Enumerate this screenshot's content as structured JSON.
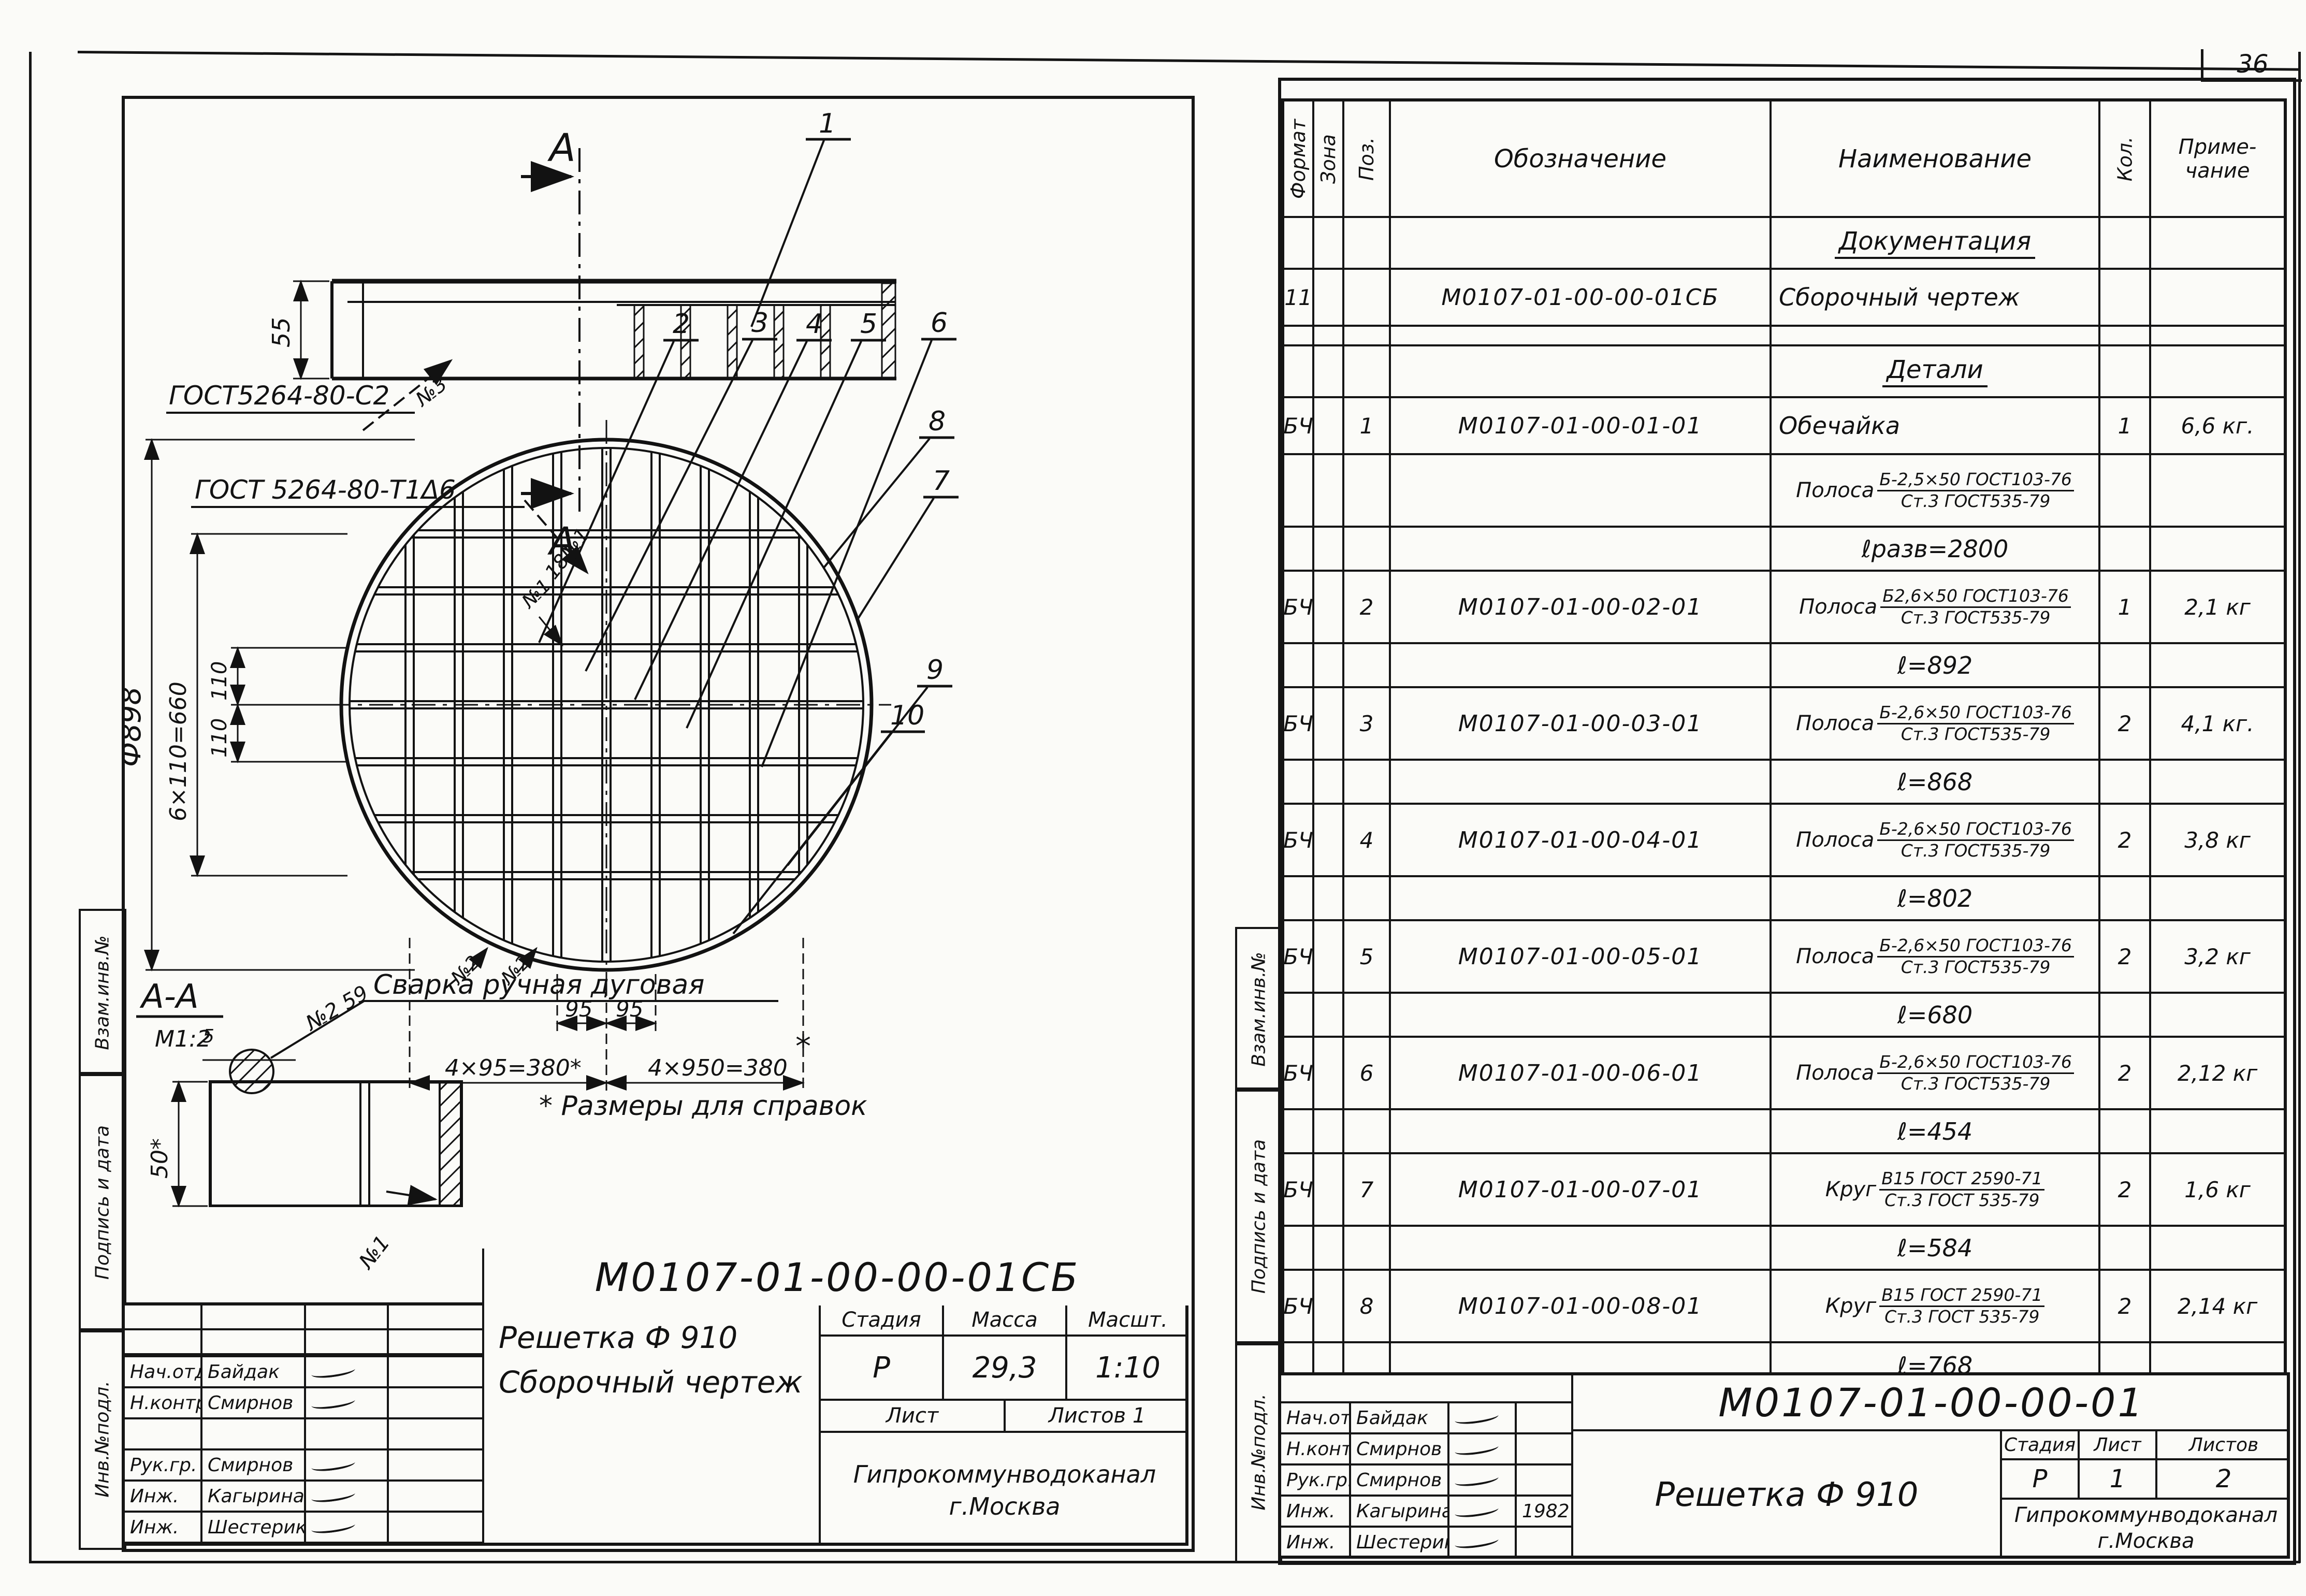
{
  "page_no": "36",
  "strip": {
    "top": "Взам.инв.№",
    "mid": "Подпись и дата",
    "bot": "Инв.№подл."
  },
  "left_page": {
    "drawing": {
      "sec_letter": "А",
      "callout_1": "1",
      "gost_c2": "ГОСТ5264-80-С2",
      "weld_n3": "№3",
      "gost_t1": "ГОСТ 5264-80-Т1Δ6",
      "weld_18n1": "18№1",
      "weld_n1": "№1",
      "weld_n2a": "№2",
      "weld_n2b": "№2",
      "callout_2": "2",
      "callout_3": "3",
      "callout_4": "4",
      "callout_5": "5",
      "callout_6": "6",
      "callout_7": "7",
      "callout_8": "8",
      "callout_9": "9",
      "callout_10": "10",
      "dim_55": "55",
      "dim_diam": "Ф898",
      "dim_660": "6×110=660",
      "dim_110a": "110",
      "dim_110b": "110",
      "dim_95a": "95",
      "dim_95b": "95",
      "dim_380l": "4×95=380*",
      "dim_380r": "4×950=380",
      "star": "*",
      "aa": "А-А",
      "aa_scale": "М1:2",
      "dim_5": "5",
      "weld_n259": "№2 59",
      "weld_note": "Сварка ручная дуговая",
      "dim_50": "50*",
      "weld_n1b": "№1",
      "ref_note": "* Размеры для справок"
    },
    "title_block": {
      "doc_no": "М0107-01-00-00-01СБ",
      "name1": "Решетка Ф 910",
      "name2": "Сборочный чертеж",
      "h_stage": "Стадия",
      "h_mass": "Масса",
      "h_scale": "Масшт.",
      "stage": "Р",
      "mass": "29,3",
      "scale": "1:10",
      "h_sheet": "Лист",
      "h_sheets": "Листов 1",
      "org": "Гипрокоммунводоканал",
      "city": "г.Москва",
      "roles": [
        {
          "r": "Нач.отд.",
          "n": "Байдак",
          "sig": true,
          "d": ""
        },
        {
          "r": "Н.контр.",
          "n": "Смирнов",
          "sig": true,
          "d": ""
        },
        {
          "r": "",
          "n": "",
          "sig": false,
          "d": ""
        },
        {
          "r": "Рук.гр.",
          "n": "Смирнов",
          "sig": true,
          "d": ""
        },
        {
          "r": "Инж.",
          "n": "Кагырина",
          "sig": true,
          "d": ""
        },
        {
          "r": "Инж.",
          "n": "Шестериков",
          "sig": true,
          "d": ""
        }
      ]
    }
  },
  "right_page": {
    "spec": {
      "headers": {
        "format": "Формат",
        "zone": "Зона",
        "pos": "Поз.",
        "designation": "Обозначение",
        "name": "Наименование",
        "qty": "Кол.",
        "note1": "Приме-",
        "note2": "чание"
      },
      "rows": [
        {
          "type": "section",
          "text": "Документация"
        },
        {
          "type": "part",
          "fmt": "11",
          "pos": "",
          "des": "М0107-01-00-00-01СБ",
          "name": "Сборочный чертеж",
          "qty": "",
          "note": ""
        },
        {
          "type": "gap"
        },
        {
          "type": "section",
          "text": "Детали"
        },
        {
          "type": "part",
          "fmt": "БЧ",
          "pos": "1",
          "des": "М0107-01-00-01-01",
          "name": "Обечайка",
          "qty": "1",
          "note": "6,6 кг."
        },
        {
          "type": "material",
          "label": "Полоса",
          "num": "Б-2,5×50 ГОСТ103-76",
          "den": "Ст.3 ГОСТ535-79"
        },
        {
          "type": "length",
          "text": "ℓразв=2800"
        },
        {
          "type": "partmat",
          "fmt": "БЧ",
          "pos": "2",
          "des": "М0107-01-00-02-01",
          "label": "Полоса",
          "num": "Б2,6×50 ГОСТ103-76",
          "den": "Ст.3 ГОСТ535-79",
          "qty": "1",
          "note": "2,1 кг"
        },
        {
          "type": "length",
          "text": "ℓ=892"
        },
        {
          "type": "partmat",
          "fmt": "БЧ",
          "pos": "3",
          "des": "М0107-01-00-03-01",
          "label": "Полоса",
          "num": "Б-2,6×50 ГОСТ103-76",
          "den": "Ст.3 ГОСТ535-79",
          "qty": "2",
          "note": "4,1 кг."
        },
        {
          "type": "length",
          "text": "ℓ=868"
        },
        {
          "type": "partmat",
          "fmt": "БЧ",
          "pos": "4",
          "des": "М0107-01-00-04-01",
          "label": "Полоса",
          "num": "Б-2,6×50 ГОСТ103-76",
          "den": "Ст.3 ГОСТ535-79",
          "qty": "2",
          "note": "3,8 кг"
        },
        {
          "type": "length",
          "text": "ℓ=802"
        },
        {
          "type": "partmat",
          "fmt": "БЧ",
          "pos": "5",
          "des": "М0107-01-00-05-01",
          "label": "Полоса",
          "num": "Б-2,6×50 ГОСТ103-76",
          "den": "Ст.3 ГОСТ535-79",
          "qty": "2",
          "note": "3,2 кг"
        },
        {
          "type": "length",
          "text": "ℓ=680"
        },
        {
          "type": "partmat",
          "fmt": "БЧ",
          "pos": "6",
          "des": "М0107-01-00-06-01",
          "label": "Полоса",
          "num": "Б-2,6×50 ГОСТ103-76",
          "den": "Ст.3 ГОСТ535-79",
          "qty": "2",
          "note": "2,12 кг"
        },
        {
          "type": "length",
          "text": "ℓ=454"
        },
        {
          "type": "partmat",
          "fmt": "БЧ",
          "pos": "7",
          "des": "М0107-01-00-07-01",
          "label": "Круг",
          "num": "В15 ГОСТ 2590-71",
          "den": "Ст.3 ГОСТ 535-79",
          "qty": "2",
          "note": "1,6 кг"
        },
        {
          "type": "length",
          "text": "ℓ=584"
        },
        {
          "type": "partmat",
          "fmt": "БЧ",
          "pos": "8",
          "des": "М0107-01-00-08-01",
          "label": "Круг",
          "num": "В15 ГОСТ 2590-71",
          "den": "Ст.3 ГОСТ 535-79",
          "qty": "2",
          "note": "2,14 кг"
        },
        {
          "type": "length",
          "text": "ℓ=768"
        }
      ]
    },
    "title_block": {
      "doc_no": "М0107-01-00-00-01",
      "name": "Решетка Ф 910",
      "h_stage": "Стадия",
      "h_sheet": "Лист",
      "h_sheets": "Листов",
      "stage": "Р",
      "sheet": "1",
      "sheets": "2",
      "org": "Гипрокоммунводоканал",
      "city": "г.Москва",
      "roles": [
        {
          "r": "Нач.отд",
          "n": "Байдак",
          "sig": true,
          "d": ""
        },
        {
          "r": "Н.контр.",
          "n": "Смирнов",
          "sig": true,
          "d": ""
        },
        {
          "r": "Рук.гр.",
          "n": "Смирнов",
          "sig": true,
          "d": ""
        },
        {
          "r": "Инж.",
          "n": "Кагырина",
          "sig": true,
          "d": "1982"
        },
        {
          "r": "Инж.",
          "n": "Шестериков",
          "sig": true,
          "d": ""
        }
      ]
    }
  }
}
